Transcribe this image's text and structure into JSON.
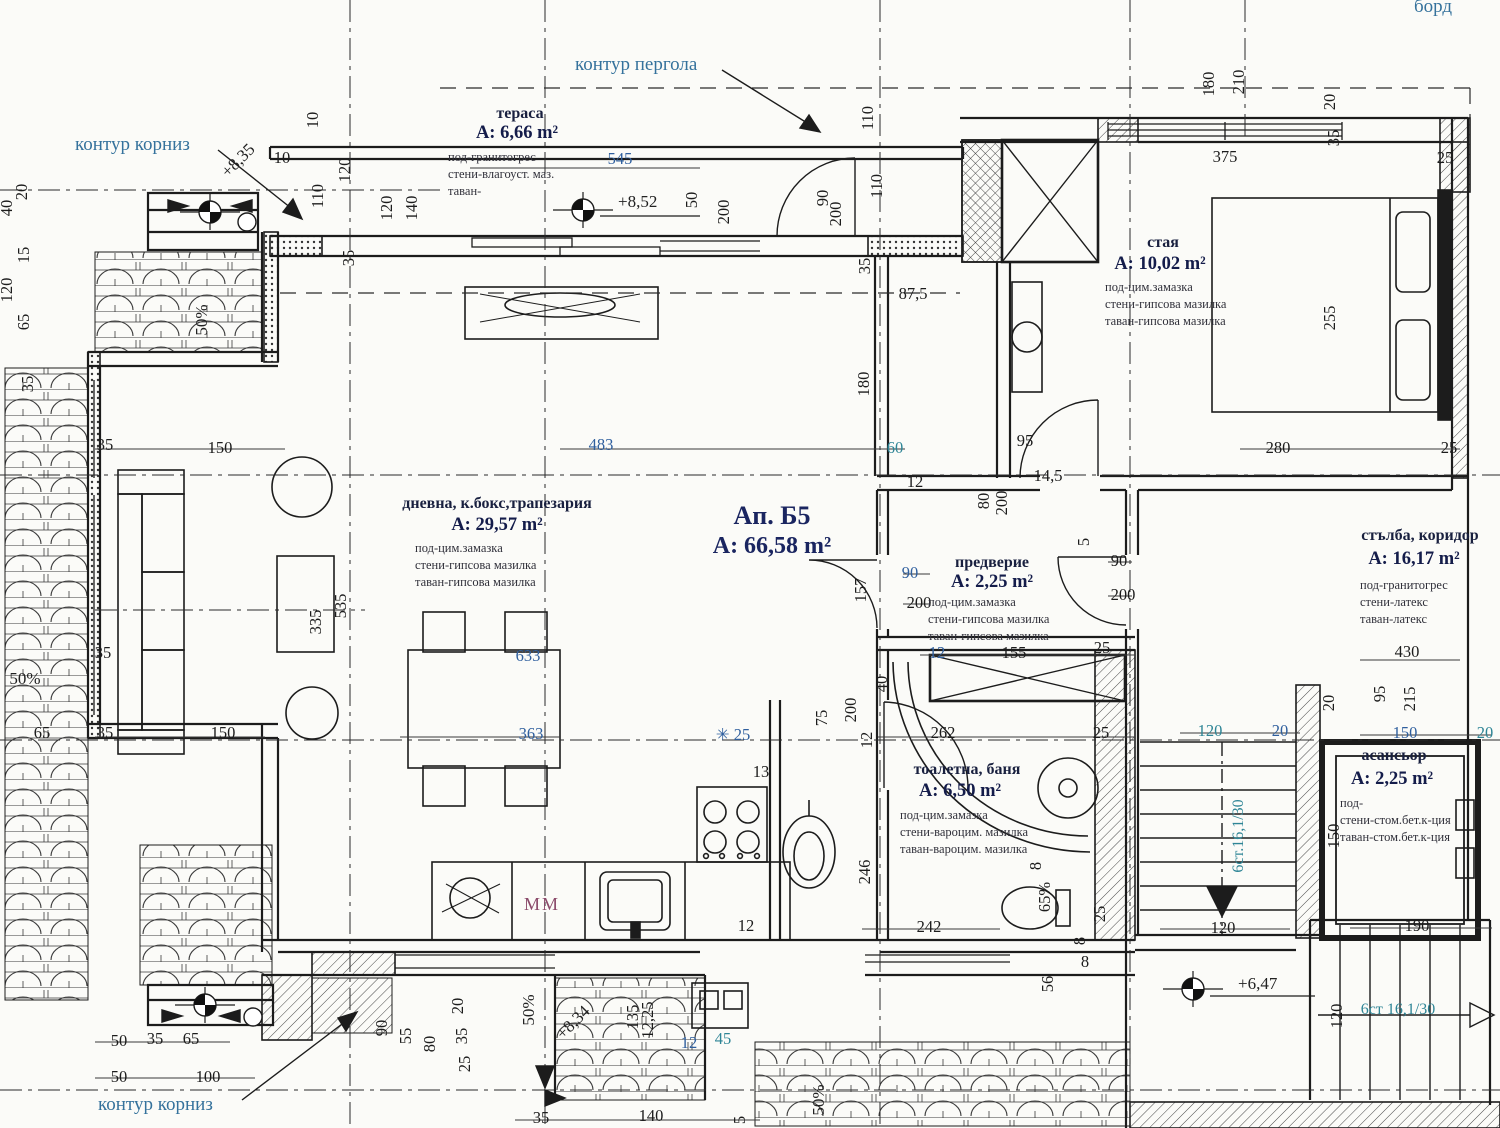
{
  "meta": {
    "title": "Ап. Б5 — A: 66,58 m² — архитектурен план"
  },
  "drawing": {
    "apartment": {
      "name": "Ап. Б5",
      "area": "A: 66,58 m²",
      "x": 772,
      "y": 524
    },
    "rooms": [
      {
        "name": "тераса",
        "area": "A: 6,66 m²",
        "nx": 520,
        "ny": 118,
        "ax": 517,
        "ay": 138,
        "fx": 448,
        "fy": 161,
        "finishes": [
          "под-гранитогрес",
          "стени-влагоуст. маз.",
          "таван-"
        ]
      },
      {
        "name": "стая",
        "area": "A: 10,02 m²",
        "nx": 1163,
        "ny": 247,
        "ax": 1160,
        "ay": 269,
        "fx": 1105,
        "fy": 291,
        "finishes": [
          "под-цим.замазка",
          "стени-гипсова мазилка",
          "таван-гипсова мазилка"
        ]
      },
      {
        "name": "дневна, к.бокс,трапезария",
        "area": "A: 29,57 m²",
        "nx": 497,
        "ny": 508,
        "ax": 497,
        "ay": 530,
        "fx": 415,
        "fy": 552,
        "finishes": [
          "под-цим.замазка",
          "стени-гипсова мазилка",
          "таван-гипсова мазилка"
        ]
      },
      {
        "name": "предверие",
        "area": "A: 2,25 m²",
        "nx": 992,
        "ny": 567,
        "ax": 992,
        "ay": 587,
        "fx": 928,
        "fy": 606,
        "finishes": [
          "под-цим.замазка",
          "стени-гипсова мазилка",
          "таван-гипсова мазилка"
        ]
      },
      {
        "name": "стълба, коридор",
        "area": "A: 16,17 m²",
        "nx": 1420,
        "ny": 540,
        "ax": 1414,
        "ay": 564,
        "fx": 1360,
        "fy": 589,
        "finishes": [
          "под-гранитогрес",
          "стени-латекс",
          "таван-латекс"
        ]
      },
      {
        "name": "тоалетна, баня",
        "area": "A: 6,50 m²",
        "nx": 967,
        "ny": 774,
        "ax": 960,
        "ay": 796,
        "fx": 900,
        "fy": 819,
        "finishes": [
          "под-цим.замазка",
          "стени-вароцим. мазилка",
          "таван-вароцим. мазилка"
        ]
      },
      {
        "name": "асансьор",
        "area": "A: 2,25 m²",
        "nx": 1394,
        "ny": 760,
        "ax": 1392,
        "ay": 784,
        "fx": 1340,
        "fy": 807,
        "finishes": [
          "под-",
          "стени-стом.бет.к-ция",
          "таван-стом.бет.к-ция"
        ]
      }
    ],
    "callouts": [
      {
        "t": "контур корниз",
        "x": 75,
        "y": 150
      },
      {
        "t": "контур пергола",
        "x": 575,
        "y": 70
      },
      {
        "t": "борд",
        "x": 1414,
        "y": 12
      },
      {
        "t": "контур корниз",
        "x": 98,
        "y": 1110
      }
    ],
    "equipment_labels": [
      {
        "t": "MM",
        "x": 524,
        "y": 910
      }
    ],
    "level_marks": [
      {
        "t": "+8,52",
        "x": 618,
        "y": 207
      },
      {
        "t": "+8,35",
        "x": 228,
        "y": 178,
        "r": 45
      },
      {
        "t": "+8,34",
        "x": 563,
        "y": 1040,
        "r": 45
      },
      {
        "t": "+6,47",
        "x": 1238,
        "y": 989
      }
    ],
    "slope_labels": [
      {
        "t": "50%",
        "x": 207,
        "y": 320,
        "r": 90
      },
      {
        "t": "50%",
        "x": 25,
        "y": 684
      },
      {
        "t": "50%",
        "x": 534,
        "y": 1010,
        "r": 90
      },
      {
        "t": "50%",
        "x": 824,
        "y": 1100,
        "r": 90
      }
    ],
    "stair_notes": [
      {
        "t": "6ст.16,1/30",
        "x": 1243,
        "y": 836,
        "r": 90
      },
      {
        "t": "6ст 16,1/30",
        "x": 1398,
        "y": 1014
      }
    ],
    "dimensions": [
      {
        "t": "10",
        "x": 318,
        "y": 120,
        "r": 90
      },
      {
        "t": "120",
        "x": 350,
        "y": 170,
        "r": 90
      },
      {
        "t": "110",
        "x": 323,
        "y": 196,
        "r": 90
      },
      {
        "t": "10",
        "x": 282,
        "y": 163
      },
      {
        "t": "120",
        "x": 392,
        "y": 208,
        "r": 90
      },
      {
        "t": "140",
        "x": 417,
        "y": 208,
        "r": 90
      },
      {
        "t": "35",
        "x": 354,
        "y": 258,
        "r": 90
      },
      {
        "t": "40",
        "x": 12,
        "y": 208,
        "r": 90
      },
      {
        "t": "120",
        "x": 12,
        "y": 290,
        "r": 90
      },
      {
        "t": "20",
        "x": 27,
        "y": 192,
        "r": 90
      },
      {
        "t": "15",
        "x": 29,
        "y": 255,
        "r": 90
      },
      {
        "t": "65",
        "x": 29,
        "y": 322,
        "r": 90
      },
      {
        "t": "35",
        "x": 33,
        "y": 384,
        "r": 90
      },
      {
        "t": "545",
        "x": 620,
        "y": 164,
        "c": "b"
      },
      {
        "t": "50",
        "x": 697,
        "y": 200,
        "r": 90
      },
      {
        "t": "200",
        "x": 729,
        "y": 212,
        "r": 90
      },
      {
        "t": "90",
        "x": 828,
        "y": 198,
        "r": 90
      },
      {
        "t": "200",
        "x": 841,
        "y": 214,
        "r": 90
      },
      {
        "t": "110",
        "x": 873,
        "y": 118,
        "r": 90
      },
      {
        "t": "110",
        "x": 882,
        "y": 186,
        "r": 90
      },
      {
        "t": "35",
        "x": 870,
        "y": 266,
        "r": 90
      },
      {
        "t": "180",
        "x": 1214,
        "y": 84,
        "r": 90
      },
      {
        "t": "210",
        "x": 1244,
        "y": 82,
        "r": 90
      },
      {
        "t": "20",
        "x": 1335,
        "y": 102,
        "r": 90
      },
      {
        "t": "35",
        "x": 1339,
        "y": 138,
        "r": 90
      },
      {
        "t": "375",
        "x": 1225,
        "y": 162
      },
      {
        "t": "25",
        "x": 1445,
        "y": 163
      },
      {
        "t": "255",
        "x": 1335,
        "y": 318,
        "r": 90
      },
      {
        "t": "280",
        "x": 1278,
        "y": 453
      },
      {
        "t": "25",
        "x": 1449,
        "y": 453
      },
      {
        "t": "35",
        "x": 105,
        "y": 450
      },
      {
        "t": "150",
        "x": 220,
        "y": 453
      },
      {
        "t": "483",
        "x": 601,
        "y": 450,
        "c": "b"
      },
      {
        "t": "60",
        "x": 895,
        "y": 453,
        "c": "t"
      },
      {
        "t": "12",
        "x": 915,
        "y": 487
      },
      {
        "t": "95",
        "x": 1025,
        "y": 446
      },
      {
        "t": "14,5",
        "x": 1048,
        "y": 481
      },
      {
        "t": "80",
        "x": 989,
        "y": 501,
        "r": 90
      },
      {
        "t": "200",
        "x": 1007,
        "y": 503,
        "r": 90
      },
      {
        "t": "5",
        "x": 1089,
        "y": 542,
        "r": 90
      },
      {
        "t": "90",
        "x": 910,
        "y": 578,
        "c": "b"
      },
      {
        "t": "200",
        "x": 919,
        "y": 608
      },
      {
        "t": "157",
        "x": 866,
        "y": 590,
        "r": 90
      },
      {
        "t": "90",
        "x": 1119,
        "y": 566
      },
      {
        "t": "200",
        "x": 1123,
        "y": 600
      },
      {
        "t": "12",
        "x": 937,
        "y": 658,
        "c": "b"
      },
      {
        "t": "155",
        "x": 1014,
        "y": 658
      },
      {
        "t": "25",
        "x": 1102,
        "y": 653
      },
      {
        "t": "335",
        "x": 321,
        "y": 622,
        "r": 90
      },
      {
        "t": "535",
        "x": 346,
        "y": 606,
        "r": 90
      },
      {
        "t": "150",
        "x": 223,
        "y": 738
      },
      {
        "t": "35",
        "x": 103,
        "y": 658
      },
      {
        "t": "35",
        "x": 105,
        "y": 738
      },
      {
        "t": "65",
        "x": 42,
        "y": 738
      },
      {
        "t": "633",
        "x": 528,
        "y": 661,
        "c": "b"
      },
      {
        "t": "363",
        "x": 531,
        "y": 739,
        "c": "b"
      },
      {
        "t": "✳ 25",
        "x": 733,
        "y": 740,
        "c": "b"
      },
      {
        "t": "13",
        "x": 761,
        "y": 777
      },
      {
        "t": "75",
        "x": 827,
        "y": 718,
        "r": 90
      },
      {
        "t": "200",
        "x": 856,
        "y": 710,
        "r": 90
      },
      {
        "t": "40",
        "x": 887,
        "y": 684,
        "r": 90
      },
      {
        "t": "12",
        "x": 872,
        "y": 740,
        "r": 90
      },
      {
        "t": "262",
        "x": 943,
        "y": 738
      },
      {
        "t": "25",
        "x": 1101,
        "y": 738
      },
      {
        "t": "246",
        "x": 870,
        "y": 872,
        "r": 90
      },
      {
        "t": "242",
        "x": 929,
        "y": 932
      },
      {
        "t": "8",
        "x": 1041,
        "y": 866,
        "r": 90
      },
      {
        "t": "65%",
        "x": 1050,
        "y": 897,
        "r": 90
      },
      {
        "t": "8",
        "x": 1085,
        "y": 967
      },
      {
        "t": "25",
        "x": 1105,
        "y": 914,
        "r": 90
      },
      {
        "t": "56",
        "x": 1053,
        "y": 984,
        "r": 90
      },
      {
        "t": "8",
        "x": 1085,
        "y": 941,
        "r": 90
      },
      {
        "t": "12",
        "x": 746,
        "y": 931
      },
      {
        "t": "90",
        "x": 387,
        "y": 1028,
        "r": 90
      },
      {
        "t": "55",
        "x": 411,
        "y": 1036,
        "r": 90
      },
      {
        "t": "80",
        "x": 435,
        "y": 1044,
        "r": 90
      },
      {
        "t": "20",
        "x": 463,
        "y": 1006,
        "r": 90
      },
      {
        "t": "35",
        "x": 467,
        "y": 1036,
        "r": 90
      },
      {
        "t": "25",
        "x": 470,
        "y": 1064,
        "r": 90
      },
      {
        "t": "135",
        "x": 638,
        "y": 1017,
        "r": 90
      },
      {
        "t": "12,25",
        "x": 653,
        "y": 1020,
        "r": 90
      },
      {
        "t": "12",
        "x": 689,
        "y": 1048,
        "c": "b"
      },
      {
        "t": "45",
        "x": 723,
        "y": 1044,
        "c": "t"
      },
      {
        "t": "35",
        "x": 541,
        "y": 1123
      },
      {
        "t": "140",
        "x": 651,
        "y": 1121
      },
      {
        "t": "5",
        "x": 745,
        "y": 1120,
        "r": 90
      },
      {
        "t": "50",
        "x": 119,
        "y": 1046
      },
      {
        "t": "35",
        "x": 155,
        "y": 1044
      },
      {
        "t": "65",
        "x": 191,
        "y": 1044
      },
      {
        "t": "50",
        "x": 119,
        "y": 1082
      },
      {
        "t": "100",
        "x": 208,
        "y": 1082
      },
      {
        "t": "430",
        "x": 1407,
        "y": 657
      },
      {
        "t": "95",
        "x": 1385,
        "y": 694,
        "r": 90
      },
      {
        "t": "215",
        "x": 1415,
        "y": 699,
        "r": 90
      },
      {
        "t": "20",
        "x": 1334,
        "y": 703,
        "r": 90
      },
      {
        "t": "120",
        "x": 1210,
        "y": 736,
        "c": "t"
      },
      {
        "t": "20",
        "x": 1280,
        "y": 736,
        "c": "b"
      },
      {
        "t": "150",
        "x": 1405,
        "y": 738,
        "c": "b"
      },
      {
        "t": "20",
        "x": 1485,
        "y": 738,
        "c": "t"
      },
      {
        "t": "150",
        "x": 1339,
        "y": 836,
        "r": 90
      },
      {
        "t": "120",
        "x": 1223,
        "y": 933
      },
      {
        "t": "190",
        "x": 1417,
        "y": 931
      },
      {
        "t": "120",
        "x": 1342,
        "y": 1016,
        "r": 90
      },
      {
        "t": "87,5",
        "x": 913,
        "y": 299
      },
      {
        "t": "180",
        "x": 869,
        "y": 384,
        "r": 90
      }
    ]
  }
}
